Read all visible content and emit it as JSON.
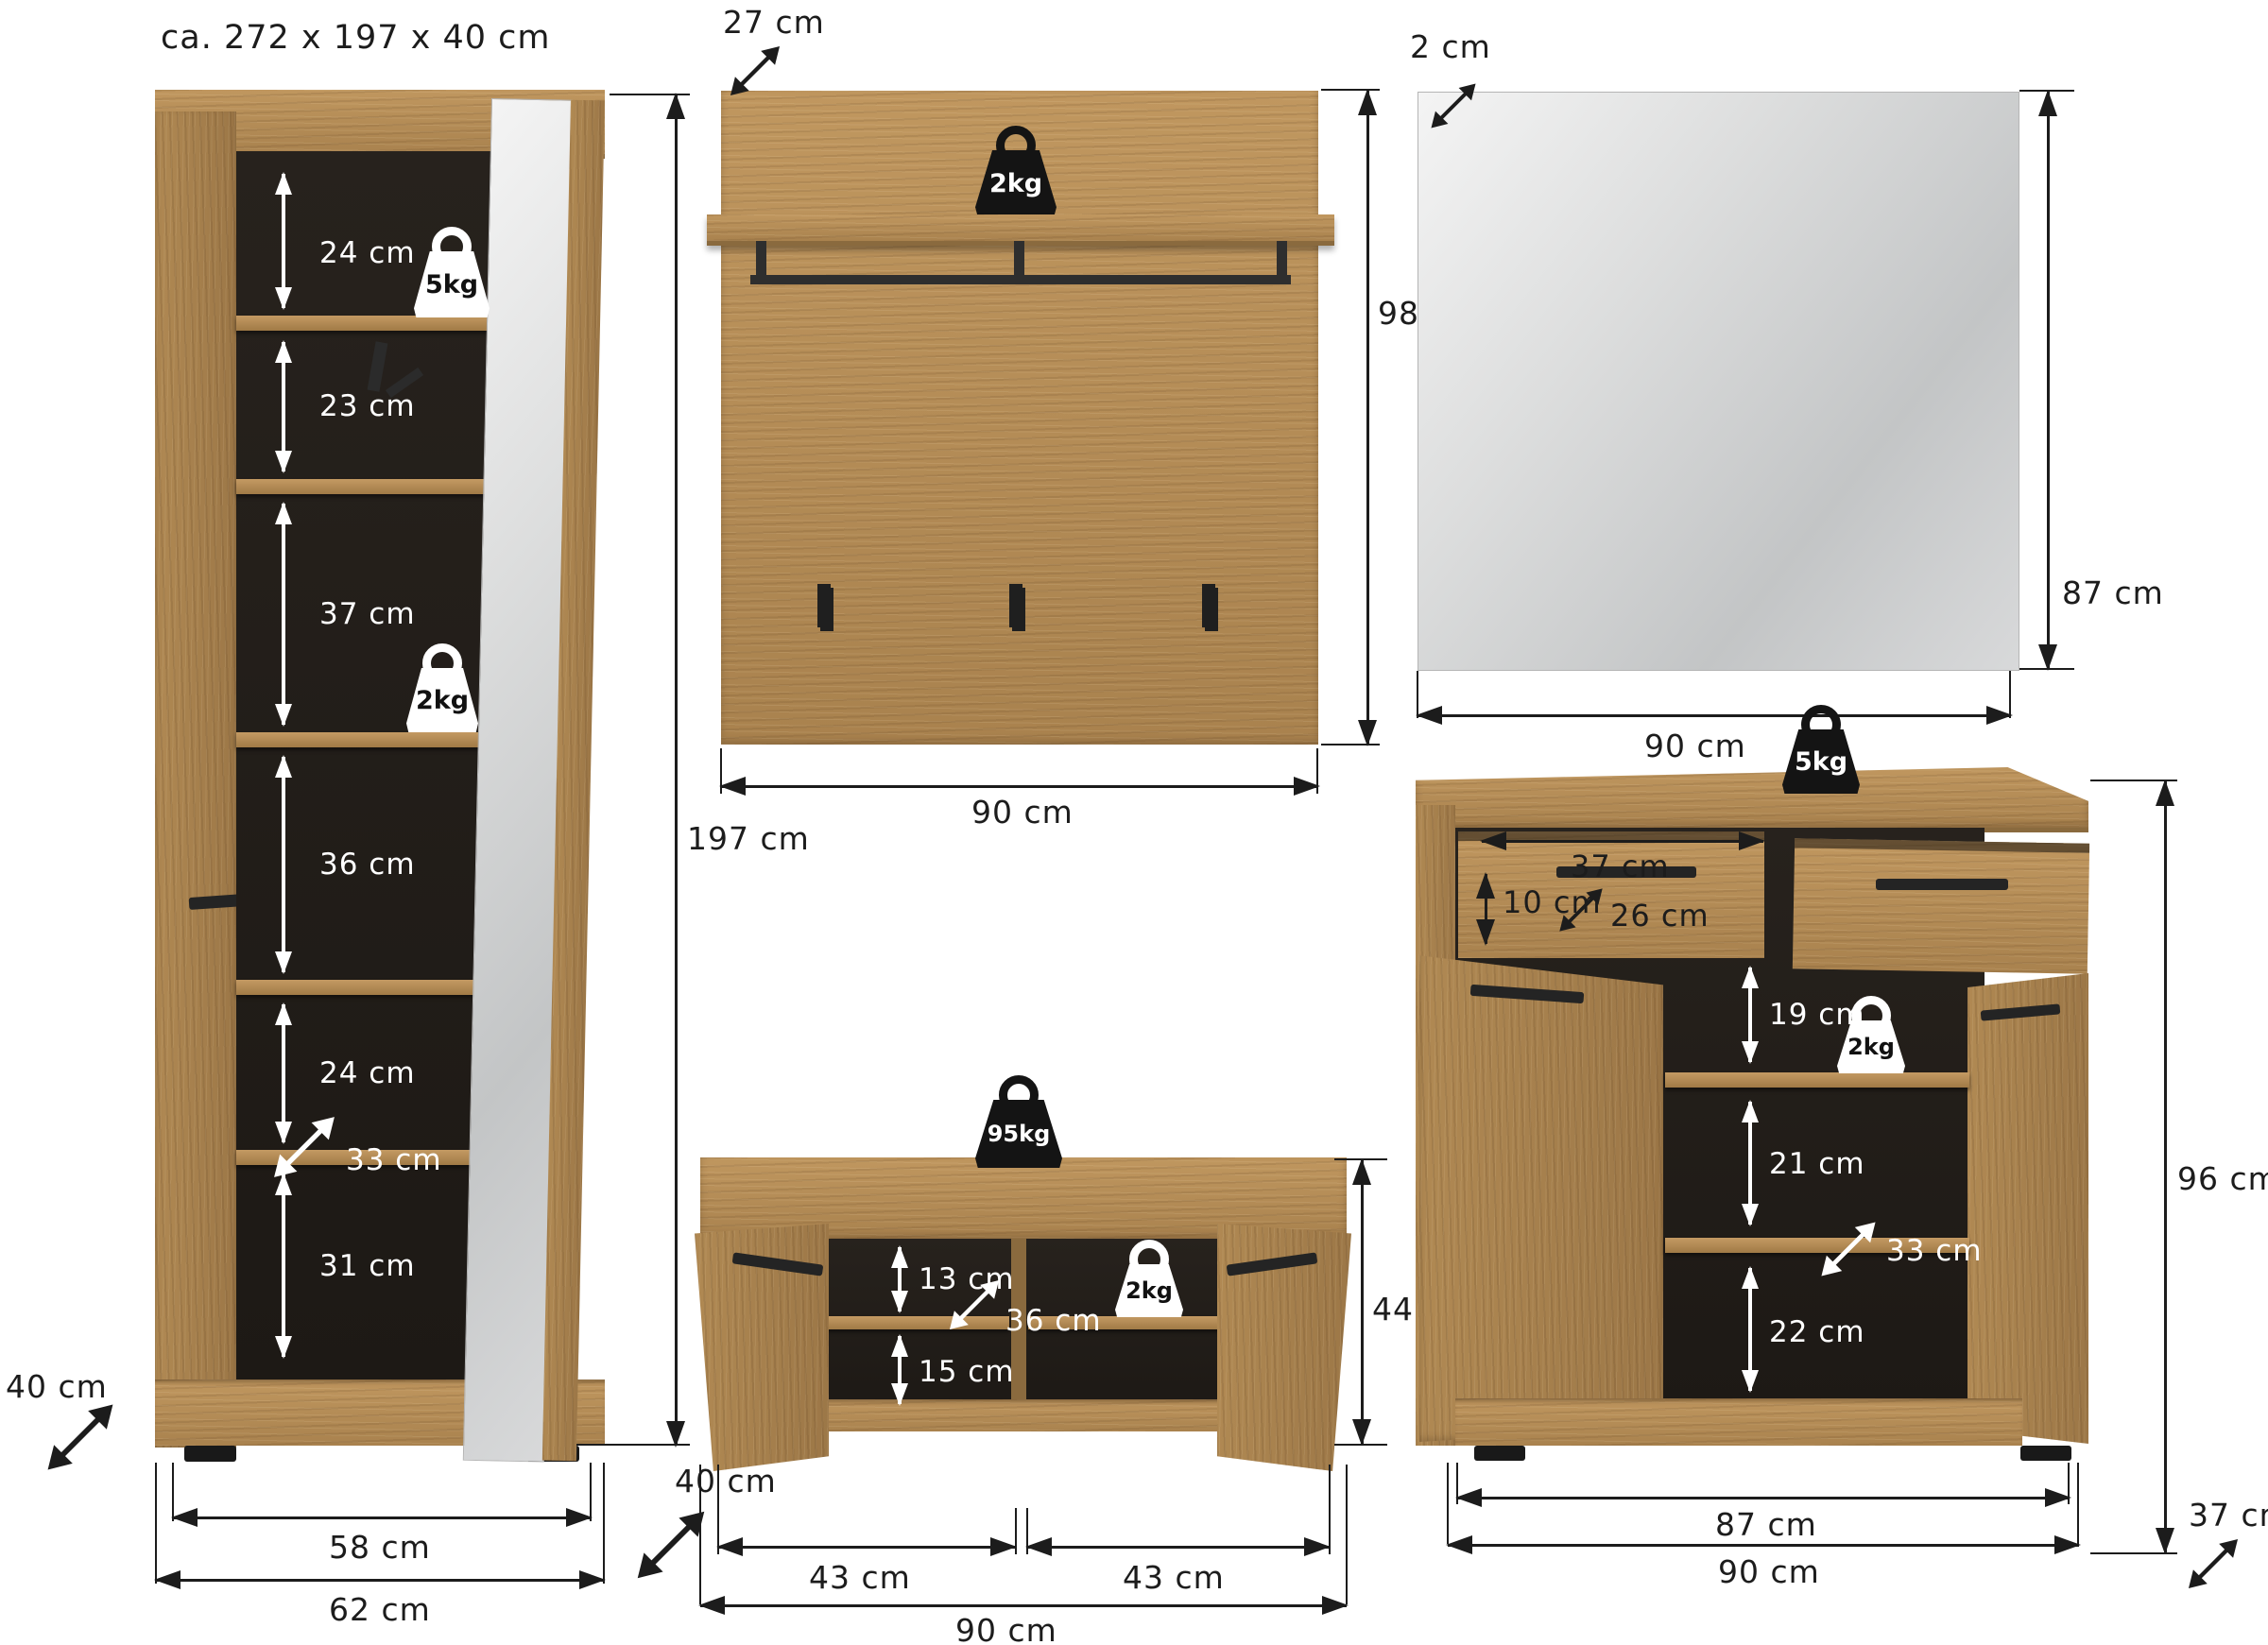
{
  "title": "ca. 272 x 197 x 40 cm",
  "wardrobe": {
    "sections": [
      "24 cm",
      "23 cm",
      "37 cm",
      "36 cm",
      "24 cm",
      "31 cm"
    ],
    "shelf_depth": "33 cm",
    "top_shelf_weight": "5kg",
    "mid_shelf_weight": "2kg",
    "inner_width": "58 cm",
    "outer_width": "62 cm",
    "depth": "40 cm",
    "total_height": "197 cm"
  },
  "panel": {
    "depth": "27 cm",
    "shelf_weight": "2kg",
    "height": "98 cm",
    "width": "90 cm"
  },
  "mirror": {
    "thickness": "2 cm",
    "height": "87 cm",
    "width": "90 cm"
  },
  "bench": {
    "top_weight": "95kg",
    "shelf_weight": "2kg",
    "upper_compartment": "13 cm",
    "shelf_depth": "36 cm",
    "lower_compartment": "15 cm",
    "height": "44 cm",
    "left_door_width": "43 cm",
    "right_door_width": "43 cm",
    "width": "90 cm",
    "depth": "40 cm"
  },
  "shoe_cabinet": {
    "top_weight": "5kg",
    "drawer_width": "37 cm",
    "drawer_height": "10 cm",
    "drawer_depth": "26 cm",
    "sections": [
      "19 cm",
      "21 cm",
      "22 cm"
    ],
    "shelf_depth": "33 cm",
    "shelf_weight": "2kg",
    "height": "96 cm",
    "depth": "37 cm",
    "inner_width": "87 cm",
    "outer_width": "90 cm"
  }
}
